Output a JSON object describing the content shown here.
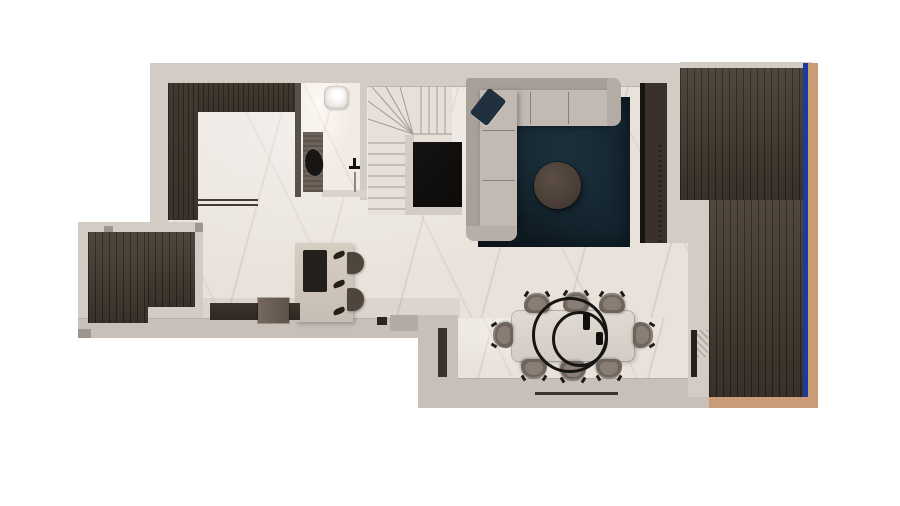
{
  "meta": {
    "title": "Top-down 3D floor plan render of an open-plan apartment level",
    "text_on_image": "none",
    "level_features": "open living/kitchen/dining space, bathroom, winder staircase, two wood-deck balconies"
  },
  "palette": {
    "background": "#ffffff",
    "wall": "#d3ccc5",
    "wall_dark": "#c7bfb8",
    "wall_shadow": "#9d958e",
    "floor_marble": "#e9e2db",
    "wood_cabinet": "#3b332b",
    "deck_wood": "#473d33",
    "rug": "#152631",
    "sofa": "#c1b9b2",
    "sofa_dark": "#a8a098",
    "coffee_table": "#4d4138",
    "dining_table": "#dbd5cd",
    "chair": "#6e645c",
    "chair_light": "#968c84",
    "glass_rail_blue": "#1e3a9c",
    "balcony_trim_tan": "#c99b77",
    "tv_black": "#0c0b0a",
    "stone_shower": "#6e635a",
    "island": "#d0c8bd"
  },
  "rooms": [
    {
      "id": "kitchen",
      "label": "Kitchen with L-shaped counter and island"
    },
    {
      "id": "bathroom",
      "label": "Bathroom with basin, toilet and stone shower"
    },
    {
      "id": "staircase",
      "label": "Winder staircase to other level"
    },
    {
      "id": "living",
      "label": "Living area with sectional sofa and rug"
    },
    {
      "id": "dining",
      "label": "Dining area with table for eight"
    },
    {
      "id": "balcony_main",
      "label": "Main balcony with wood decking (right)"
    },
    {
      "id": "balcony_small",
      "label": "Small balcony with wood decking (left)"
    }
  ],
  "furniture": {
    "sofa": "L-shaped sectional sofa with dark throw pillow",
    "rug": "Dark teal area rug",
    "coffee_table": "Round dark-wood coffee table",
    "tv": "Black TV / media panel on stair partition",
    "tall_unit": "Tall dark storage unit with curtain beside balcony",
    "dining_table": "Rectangular light dining table",
    "dining_chairs": 8,
    "pendant_rings": 2,
    "kitchen_counter": "L-shaped dark wood kitchen counter",
    "kitchen_island": "Stone kitchen island with dark cooktop",
    "bar_stools": 2,
    "sideboard": "Low dark sideboard with box seat",
    "toilet": "Black toilet",
    "sink": "White washbasin",
    "shower": "Shower with dark stone floor panel and tap",
    "staircase": "Winder staircase",
    "glass_railing": "Blue glass balcony railing",
    "balcony_trim": "Tan balcony edge trim",
    "window": "Window slot in dining wall"
  }
}
